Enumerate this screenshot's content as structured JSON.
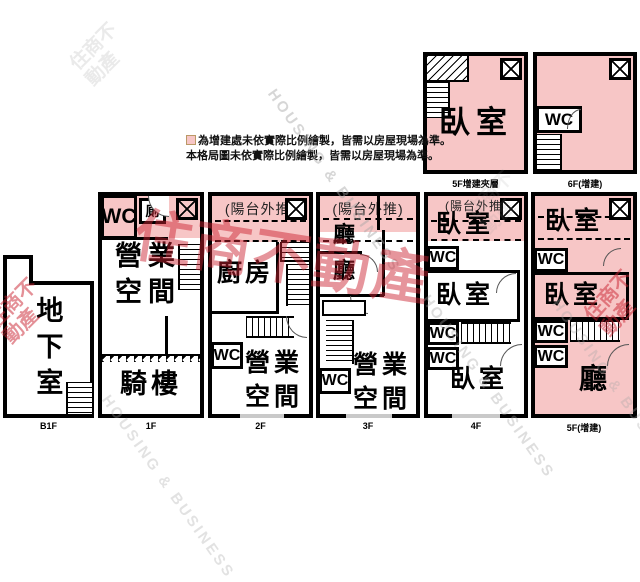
{
  "legend": {
    "line1": "為增建處未依實際比例繪製，皆需以房屋現場為準。",
    "line2": "本格局圖未依實際比例繪製，皆需以房屋現場為準。"
  },
  "watermarks": {
    "housing": "HOUSING & BUSINESS",
    "brand": "住商不動產"
  },
  "colors": {
    "addition_pink": "#f7c6c6",
    "wall_black": "#000000",
    "watermark_red": "#ca2230",
    "watermark_gray": "#a5a5a5"
  },
  "floors": {
    "b1f": {
      "label": "B1F",
      "basement": "地下室"
    },
    "f1": {
      "label": "1F",
      "wc": "WC",
      "toilet": "廁",
      "business": "營業空間",
      "arcade": "騎樓"
    },
    "f2": {
      "label": "2F",
      "balcony": "(陽台外推)",
      "kitchen": "廚房",
      "wc": "WC",
      "business": "營業空間"
    },
    "f3": {
      "label": "3F",
      "balcony": "(陽台外推)",
      "hall_upper": "廳",
      "hall_lower": "廳",
      "wc": "WC",
      "business": "營業空間"
    },
    "f4": {
      "label": "4F",
      "balcony": "(陽台外推)",
      "bed_front": "臥室",
      "wc1": "WC",
      "bed_middle": "臥室",
      "wc2": "WC",
      "wc3": "WC",
      "bed_rear": "臥室"
    },
    "f5": {
      "label": "5F(增建)",
      "bed_front": "臥室",
      "wc1": "WC",
      "bed_middle": "臥室",
      "wc2": "WC",
      "wc3": "WC",
      "hall": "廳"
    },
    "f5_mezz": {
      "label": "5F增建夾層",
      "bed": "臥室"
    },
    "f6": {
      "label": "6F(增建)",
      "wc": "WC"
    }
  }
}
